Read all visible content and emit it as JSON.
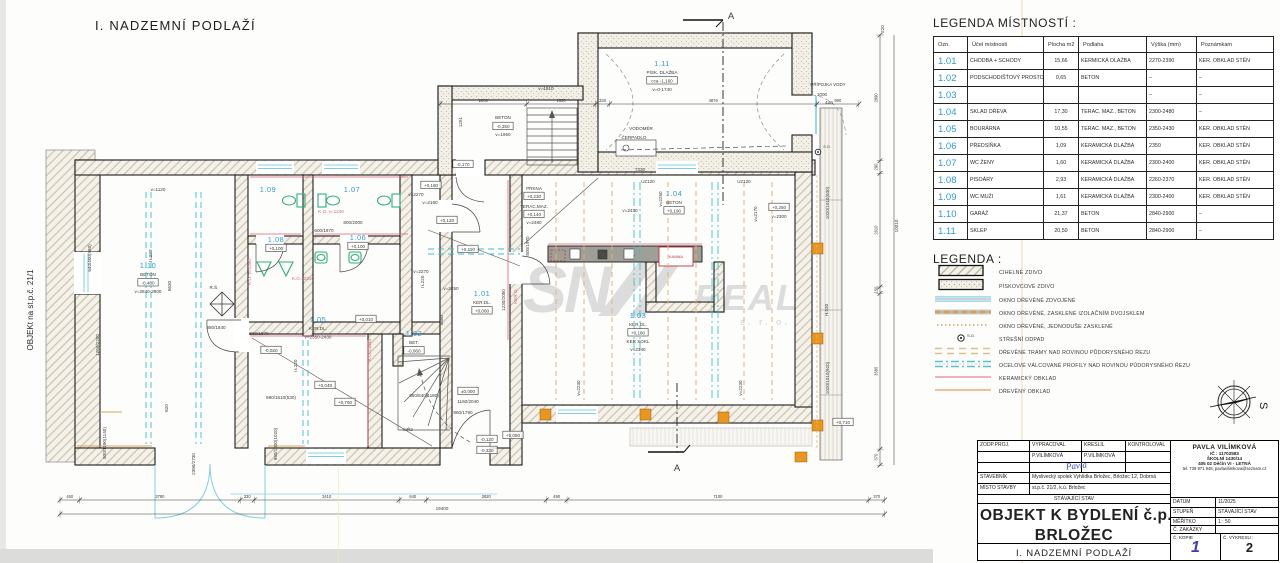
{
  "plan": {
    "title": "I. NADZEMNÍ PODLAŽÍ",
    "side_label": "OBJEKt na st.p.č. 21/1",
    "watermark": {
      "big": "SN",
      "mid": "REAL",
      "small": "s. r. o."
    },
    "colors": {
      "room_id": "#2e9bd6",
      "pink": "#d4677f",
      "red": "#c03040",
      "green": "#2fae7d",
      "cyan": "#7fd0e2",
      "teal": "#3bbfc9",
      "orange_dash": "#e5b36b",
      "orange": "#e8961e"
    },
    "rooms": [
      {
        "id": "1.10",
        "x": 148,
        "y": 268,
        "lines": [
          "BETON",
          "[-0,480]",
          "v=2840-2900"
        ]
      },
      {
        "id": "1.11",
        "x": 662,
        "y": 66,
        "lines": [
          "PÍSK. DLAŽBA",
          "[cca -1,160]",
          "v=0-1740"
        ]
      },
      {
        "id": "1.09",
        "x": 268,
        "y": 192,
        "lines": []
      },
      {
        "id": "1.07",
        "x": 352,
        "y": 192,
        "lines": []
      },
      {
        "id": "1.08",
        "x": 276,
        "y": 242,
        "lines": [
          "[+0,100]"
        ]
      },
      {
        "id": "1.06",
        "x": 358,
        "y": 240,
        "lines": [
          "[+0,100]"
        ]
      },
      {
        "id": "1.05",
        "x": 318,
        "y": 322,
        "lines": [
          "KER.DL.",
          "v=2350-2430"
        ]
      },
      {
        "id": "1.02",
        "x": 414,
        "y": 336,
        "lines": [
          "BET.",
          "[-0,060]"
        ]
      },
      {
        "id": "1.01",
        "x": 482,
        "y": 296,
        "lines": [
          "KER.DL.",
          "[+0,060]"
        ]
      },
      {
        "id": "1.03",
        "x": 638,
        "y": 318,
        "lines": [
          "KER.DL.",
          "[+0,180]",
          "KER SOKL",
          "v=2340"
        ]
      },
      {
        "id": "1.04",
        "x": 674,
        "y": 196,
        "lines": [
          "BETON",
          "[+0,190]"
        ]
      }
    ],
    "annotations": [
      {
        "t": "v=1120",
        "x": 158,
        "y": 191
      },
      {
        "t": "5630",
        "x": 171,
        "y": 286,
        "r": -90
      },
      {
        "t": "820",
        "x": 168,
        "y": 408,
        "r": -90
      },
      {
        "t": "I Ł220",
        "x": 152,
        "y": 256,
        "r": -90
      },
      {
        "t": "I Ł220",
        "x": 297,
        "y": 366,
        "r": -90
      },
      {
        "t": "I Ł220",
        "x": 424,
        "y": 282,
        "r": -90
      },
      {
        "t": "R.Š.",
        "x": 214,
        "y": 289
      },
      {
        "t": "640/400(980)",
        "x": 91,
        "y": 258,
        "r": -90
      },
      {
        "t": "1260/2200",
        "x": 99,
        "y": 345,
        "r": -90
      },
      {
        "t": "880/1840",
        "x": 216,
        "y": 329
      },
      {
        "t": "860/1870",
        "x": 259,
        "y": 335
      },
      {
        "t": "-0,020",
        "x": 271,
        "y": 352,
        "b": 1
      },
      {
        "t": "800/2000",
        "x": 353,
        "y": 224
      },
      {
        "t": "600/1970",
        "x": 324,
        "y": 232
      },
      {
        "t": "K.O. v=1240",
        "x": 331,
        "y": 213,
        "c": "p"
      },
      {
        "t": "K.O. v=1395",
        "x": 251,
        "y": 272,
        "r": -90,
        "c": "p"
      },
      {
        "t": "K.O.=2310",
        "x": 303,
        "y": 280,
        "c": "p"
      },
      {
        "t": "KER O.",
        "x": 517,
        "y": 296,
        "r": -90,
        "c": "p"
      },
      {
        "t": "K.O.=1640",
        "x": 371,
        "y": 350,
        "r": -90,
        "c": "p"
      },
      {
        "t": "+0,010",
        "x": 366,
        "y": 321,
        "b": 1
      },
      {
        "t": "+0,040",
        "x": 325,
        "y": 387,
        "b": 1
      },
      {
        "t": "+0,760",
        "x": 345,
        "y": 404,
        "b": 1
      },
      {
        "t": "980/1510(530)",
        "x": 281,
        "y": 399
      },
      {
        "t": "980/1000(1020)",
        "x": 277,
        "y": 444,
        "r": -90
      },
      {
        "t": "800/1190(1140)",
        "x": 106,
        "y": 443,
        "r": -90
      },
      {
        "t": "2390/2730",
        "x": 195,
        "y": 464,
        "r": -90
      },
      {
        "t": "mŘ2",
        "x": 408,
        "y": 431
      },
      {
        "t": "650/840(1180)",
        "x": 424,
        "y": 397
      },
      {
        "t": "±0,000",
        "x": 468,
        "y": 393,
        "b": 1
      },
      {
        "t": "1160/2040",
        "x": 468,
        "y": 403
      },
      {
        "t": "860/1790",
        "x": 463,
        "y": 414
      },
      {
        "t": "-0,120",
        "x": 487,
        "y": 441,
        "b": 1
      },
      {
        "t": "-0,330",
        "x": 487,
        "y": 452,
        "b": 1
      },
      {
        "t": "+0,050",
        "x": 513,
        "y": 437,
        "b": 1
      },
      {
        "t": "5680",
        "x": 443,
        "y": 320,
        "r": -90
      },
      {
        "t": "v=2250",
        "x": 451,
        "y": 290
      },
      {
        "t": "v=2270",
        "x": 416,
        "y": 196
      },
      {
        "t": "+0,180",
        "x": 431,
        "y": 187,
        "b": 1
      },
      {
        "t": "v=2160",
        "x": 430,
        "y": 204
      },
      {
        "t": "+0,120",
        "x": 447,
        "y": 222,
        "b": 1
      },
      {
        "t": "v=2270",
        "x": 421,
        "y": 273
      },
      {
        "t": "+0,110",
        "x": 468,
        "y": 251,
        "b": 1
      },
      {
        "t": "1230/2050",
        "x": 505,
        "y": 300,
        "r": -90
      },
      {
        "t": "800/1970",
        "x": 529,
        "y": 246,
        "r": -90
      },
      {
        "t": "7330",
        "x": 640,
        "y": 171
      },
      {
        "t": "PRKNA",
        "x": 534,
        "y": 190
      },
      {
        "t": "+0,230",
        "x": 534,
        "y": 198,
        "b": 1
      },
      {
        "t": "TERAC.MAZ.",
        "x": 534,
        "y": 208
      },
      {
        "t": "+0,140",
        "x": 534,
        "y": 216,
        "b": 1
      },
      {
        "t": "v=2480",
        "x": 534,
        "y": 224
      },
      {
        "t": "U≠120",
        "x": 648,
        "y": 183
      },
      {
        "t": "U≠120",
        "x": 744,
        "y": 183
      },
      {
        "t": "v=2430",
        "x": 630,
        "y": 212
      },
      {
        "t": "v=2250",
        "x": 662,
        "y": 199,
        "r": -90
      },
      {
        "t": "v=2170",
        "x": 757,
        "y": 214,
        "r": -90
      },
      {
        "t": "+0,250",
        "x": 779,
        "y": 209,
        "b": 1
      },
      {
        "t": "v=2300",
        "x": 779,
        "y": 218
      },
      {
        "t": "v=2230",
        "x": 580,
        "y": 388,
        "r": -90
      },
      {
        "t": "v=2230",
        "x": 742,
        "y": 388,
        "r": -90
      },
      {
        "t": "KAMNA",
        "x": 676,
        "y": 258,
        "c": "r",
        "fs": 4
      },
      {
        "t": "VODOMĚR",
        "x": 641,
        "y": 130
      },
      {
        "t": "ČERPADLO",
        "x": 634,
        "y": 139
      },
      {
        "t": "PŘÍPOJKA VODY",
        "x": 828,
        "y": 86,
        "fs": 4.4
      },
      {
        "t": "1000",
        "x": 822,
        "y": 96
      },
      {
        "t": "440",
        "x": 829,
        "y": 104
      },
      {
        "t": "v=1810",
        "x": 546,
        "y": 90
      },
      {
        "t": "1251",
        "x": 462,
        "y": 122,
        "r": -90
      },
      {
        "t": "BETON",
        "x": 503,
        "y": 119
      },
      {
        "t": "-0,350",
        "x": 503,
        "y": 128,
        "b": 1
      },
      {
        "t": "v=1950",
        "x": 503,
        "y": 136
      },
      {
        "t": "-0,170",
        "x": 463,
        "y": 166,
        "b": 1
      },
      {
        "t": "H.530",
        "x": 828,
        "y": 310,
        "r": -90
      },
      {
        "t": "1020/1010(930)",
        "x": 829,
        "y": 203,
        "r": -90
      },
      {
        "t": "1020/1010(920)",
        "x": 829,
        "y": 378,
        "r": -90
      },
      {
        "t": "+0,710",
        "x": 843,
        "y": 424,
        "b": 1
      },
      {
        "t": "S.O.",
        "x": 827,
        "y": 148,
        "fs": 3.8
      },
      {
        "t": "220",
        "x": 884,
        "y": 29,
        "r": -90
      },
      {
        "t": "10010",
        "x": 898,
        "y": 226,
        "r": -90
      },
      {
        "t": "19400",
        "x": 442,
        "y": 510
      },
      {
        "t": "A",
        "x": 731,
        "y": 19,
        "fs": 9.5
      },
      {
        "t": "A",
        "x": 677,
        "y": 471,
        "fs": 9.5
      }
    ],
    "dims": {
      "bottom": {
        "values": [
          "460",
          "3780",
          "330",
          "3410",
          "640",
          "2820",
          "490",
          "7100",
          "370"
        ],
        "total": "19400"
      },
      "right": {
        "values": [
          "2890",
          "290",
          "2610",
          "150",
          "3580",
          "370"
        ],
        "total": "10010",
        "top_extra": "220"
      },
      "top": {
        "values": [
          "2040",
          "1620",
          "330",
          "4876",
          "990"
        ]
      }
    }
  },
  "legend_table": {
    "title": "LEGENDA MÍSTNOSTÍ :",
    "headers": [
      "Ozn.",
      "Účel místnosti",
      "Plocha m2",
      "Podlaha",
      "Výška (mm)",
      "Poznámkam"
    ],
    "rows": [
      {
        "ozn": "1.01",
        "ucel": "CHODBA + SCHODY",
        "plocha": "15,66",
        "podlaha": "KERMICKÁ DLAŽBA",
        "vyska": "2270-2390",
        "pozn": "KER. OBKLAD STĚN"
      },
      {
        "ozn": "1.02",
        "ucel": "PODSCHODIŠŤOVÝ PROSTOR",
        "plocha": "0,65",
        "podlaha": "BETON",
        "vyska": "–",
        "pozn": "–"
      },
      {
        "ozn": "1.03",
        "ucel": "",
        "plocha": "",
        "podlaha": "",
        "vyska": "–",
        "pozn": "–"
      },
      {
        "ozn": "1.04",
        "ucel": "SKLAD DŘEVA",
        "plocha": "17,30",
        "podlaha": "TERAC. MAZ., BETON",
        "vyska": "2300-2480",
        "pozn": "–"
      },
      {
        "ozn": "1.05",
        "ucel": "BOURÁRNA",
        "plocha": "10,55",
        "podlaha": "TERAC. MAZ., BETON",
        "vyska": "2350-2430",
        "pozn": "KER. OBKLAD STĚN"
      },
      {
        "ozn": "1.06",
        "ucel": "PŘEDSÍŇKA",
        "plocha": "1,09",
        "podlaha": "KERAMICKÁ DLAŽBA",
        "vyska": "2350",
        "pozn": "KER. OBKLAD STĚN"
      },
      {
        "ozn": "1.07",
        "ucel": "WC ŽENY",
        "plocha": "1,60",
        "podlaha": "KERAMICKÁ DLAŽBA",
        "vyska": "2300-2400",
        "pozn": "KER. OBKLAD STĚN"
      },
      {
        "ozn": "1.08",
        "ucel": "PISOÁRY",
        "plocha": "2,93",
        "podlaha": "KERAMICKÁ DLAŽBA",
        "vyska": "2260-2370",
        "pozn": "KER. OBKLAD STĚN"
      },
      {
        "ozn": "1.09",
        "ucel": "WC MUŽI",
        "plocha": "1,61",
        "podlaha": "KERAMICKÁ DLAŽBA",
        "vyska": "2300-2400",
        "pozn": "KER. OBKLAD STĚN"
      },
      {
        "ozn": "1.10",
        "ucel": "GARÁŽ",
        "plocha": "21,37",
        "podlaha": "BETON",
        "vyska": "2840-2900",
        "pozn": "–"
      },
      {
        "ozn": "1.11",
        "ucel": "SKLEP",
        "plocha": "20,50",
        "podlaha": "BETON",
        "vyska": "2840-2900",
        "pozn": "–"
      }
    ]
  },
  "legend_symbols": {
    "title": "LEGENDA :",
    "items": [
      {
        "type": "brick-masonry",
        "label": "CIHELNÉ ZDIVO"
      },
      {
        "type": "sandstone-masonry",
        "label": "PÍSKOVCOVÉ ZDIVO"
      },
      {
        "type": "window-double",
        "label": "OKNO DŘEVĚNÉ ZDVOJENÉ"
      },
      {
        "type": "window-insulated",
        "label": "OKNO DŘEVĚNÉ, ZASKLENÉ IZOLAČNÍM DVOJSKLEM"
      },
      {
        "type": "window-single-glazed",
        "label": "OKNO DŘEVĚNÉ, JEDNODUŠE ZASKLENÉ"
      },
      {
        "type": "roof-drain",
        "label": "STŘEŠNÍ ODPAD",
        "symbol": "S.O."
      },
      {
        "type": "wooden-beams",
        "label": "DŘEVĚNÉ TRÁMY NAD ROVINOU PŮDORYSNÉHO ŘEZU"
      },
      {
        "type": "steel-profiles",
        "label": "OCELOVÉ VÁLCOVANÉ PROFILY NAD ROVINOU PŮDORYSNÉHO ŘEZU"
      },
      {
        "type": "ceramic-cladding",
        "label": "KERAMICKÝ OBKLAD"
      },
      {
        "type": "wooden-cladding",
        "label": "DŘEVĚNÝ OBKLAD"
      }
    ]
  },
  "compass": {
    "label": "S"
  },
  "title_block": {
    "row1": [
      "ZODP.PROJ.",
      "VYPRACOVAL",
      "KRESLIL",
      "KONTROLOVAL"
    ],
    "row2": [
      "",
      "P.VILÍMKOVÁ",
      "P.VILÍMKOVÁ",
      ""
    ],
    "signature": "Pavla",
    "stavebnik_label": "STAVEBNÍK",
    "stavebnik_value": "Myslivecký spolek Vyhlídka Brložec, Brložec 12, Dobrná",
    "misto_label": "MÍSTO STAVBY",
    "misto_value": "st.p.č. 21/2, k.ú. Brložec",
    "stav": "STÁVAJÍCÍ STAV",
    "title_line1": "OBJEKT K BYDLENÍ č.p. 12",
    "title_line2": "BRLOŽEC",
    "subtitle": "I. NADZEMNÍ PODLAŽÍ",
    "architect": {
      "name": "PAVLA VILÍMKOVÁ",
      "ic": "IČ : 11702583",
      "street": "ŠKOLNÍ 1430/14",
      "city": "405 02 Děčín VI - LETNÁ",
      "tel": "tel. 739 971 948, pavlavilimkova@seznam.cz"
    },
    "datum_label": "DATUM",
    "datum": "11/2025",
    "stupen_label": "STUPEŇ",
    "stupen": "STÁVAJÍCÍ STAV",
    "meritko_label": "MĚŘÍTKO",
    "meritko": "1 : 50",
    "zakazky_label": "Č. ZAKÁZKY",
    "zakazky": "",
    "kopie_label": "Č. KOPIE",
    "kopie": "1",
    "vykres_label": "Č. VÝKRESU :",
    "vykres": "2"
  }
}
